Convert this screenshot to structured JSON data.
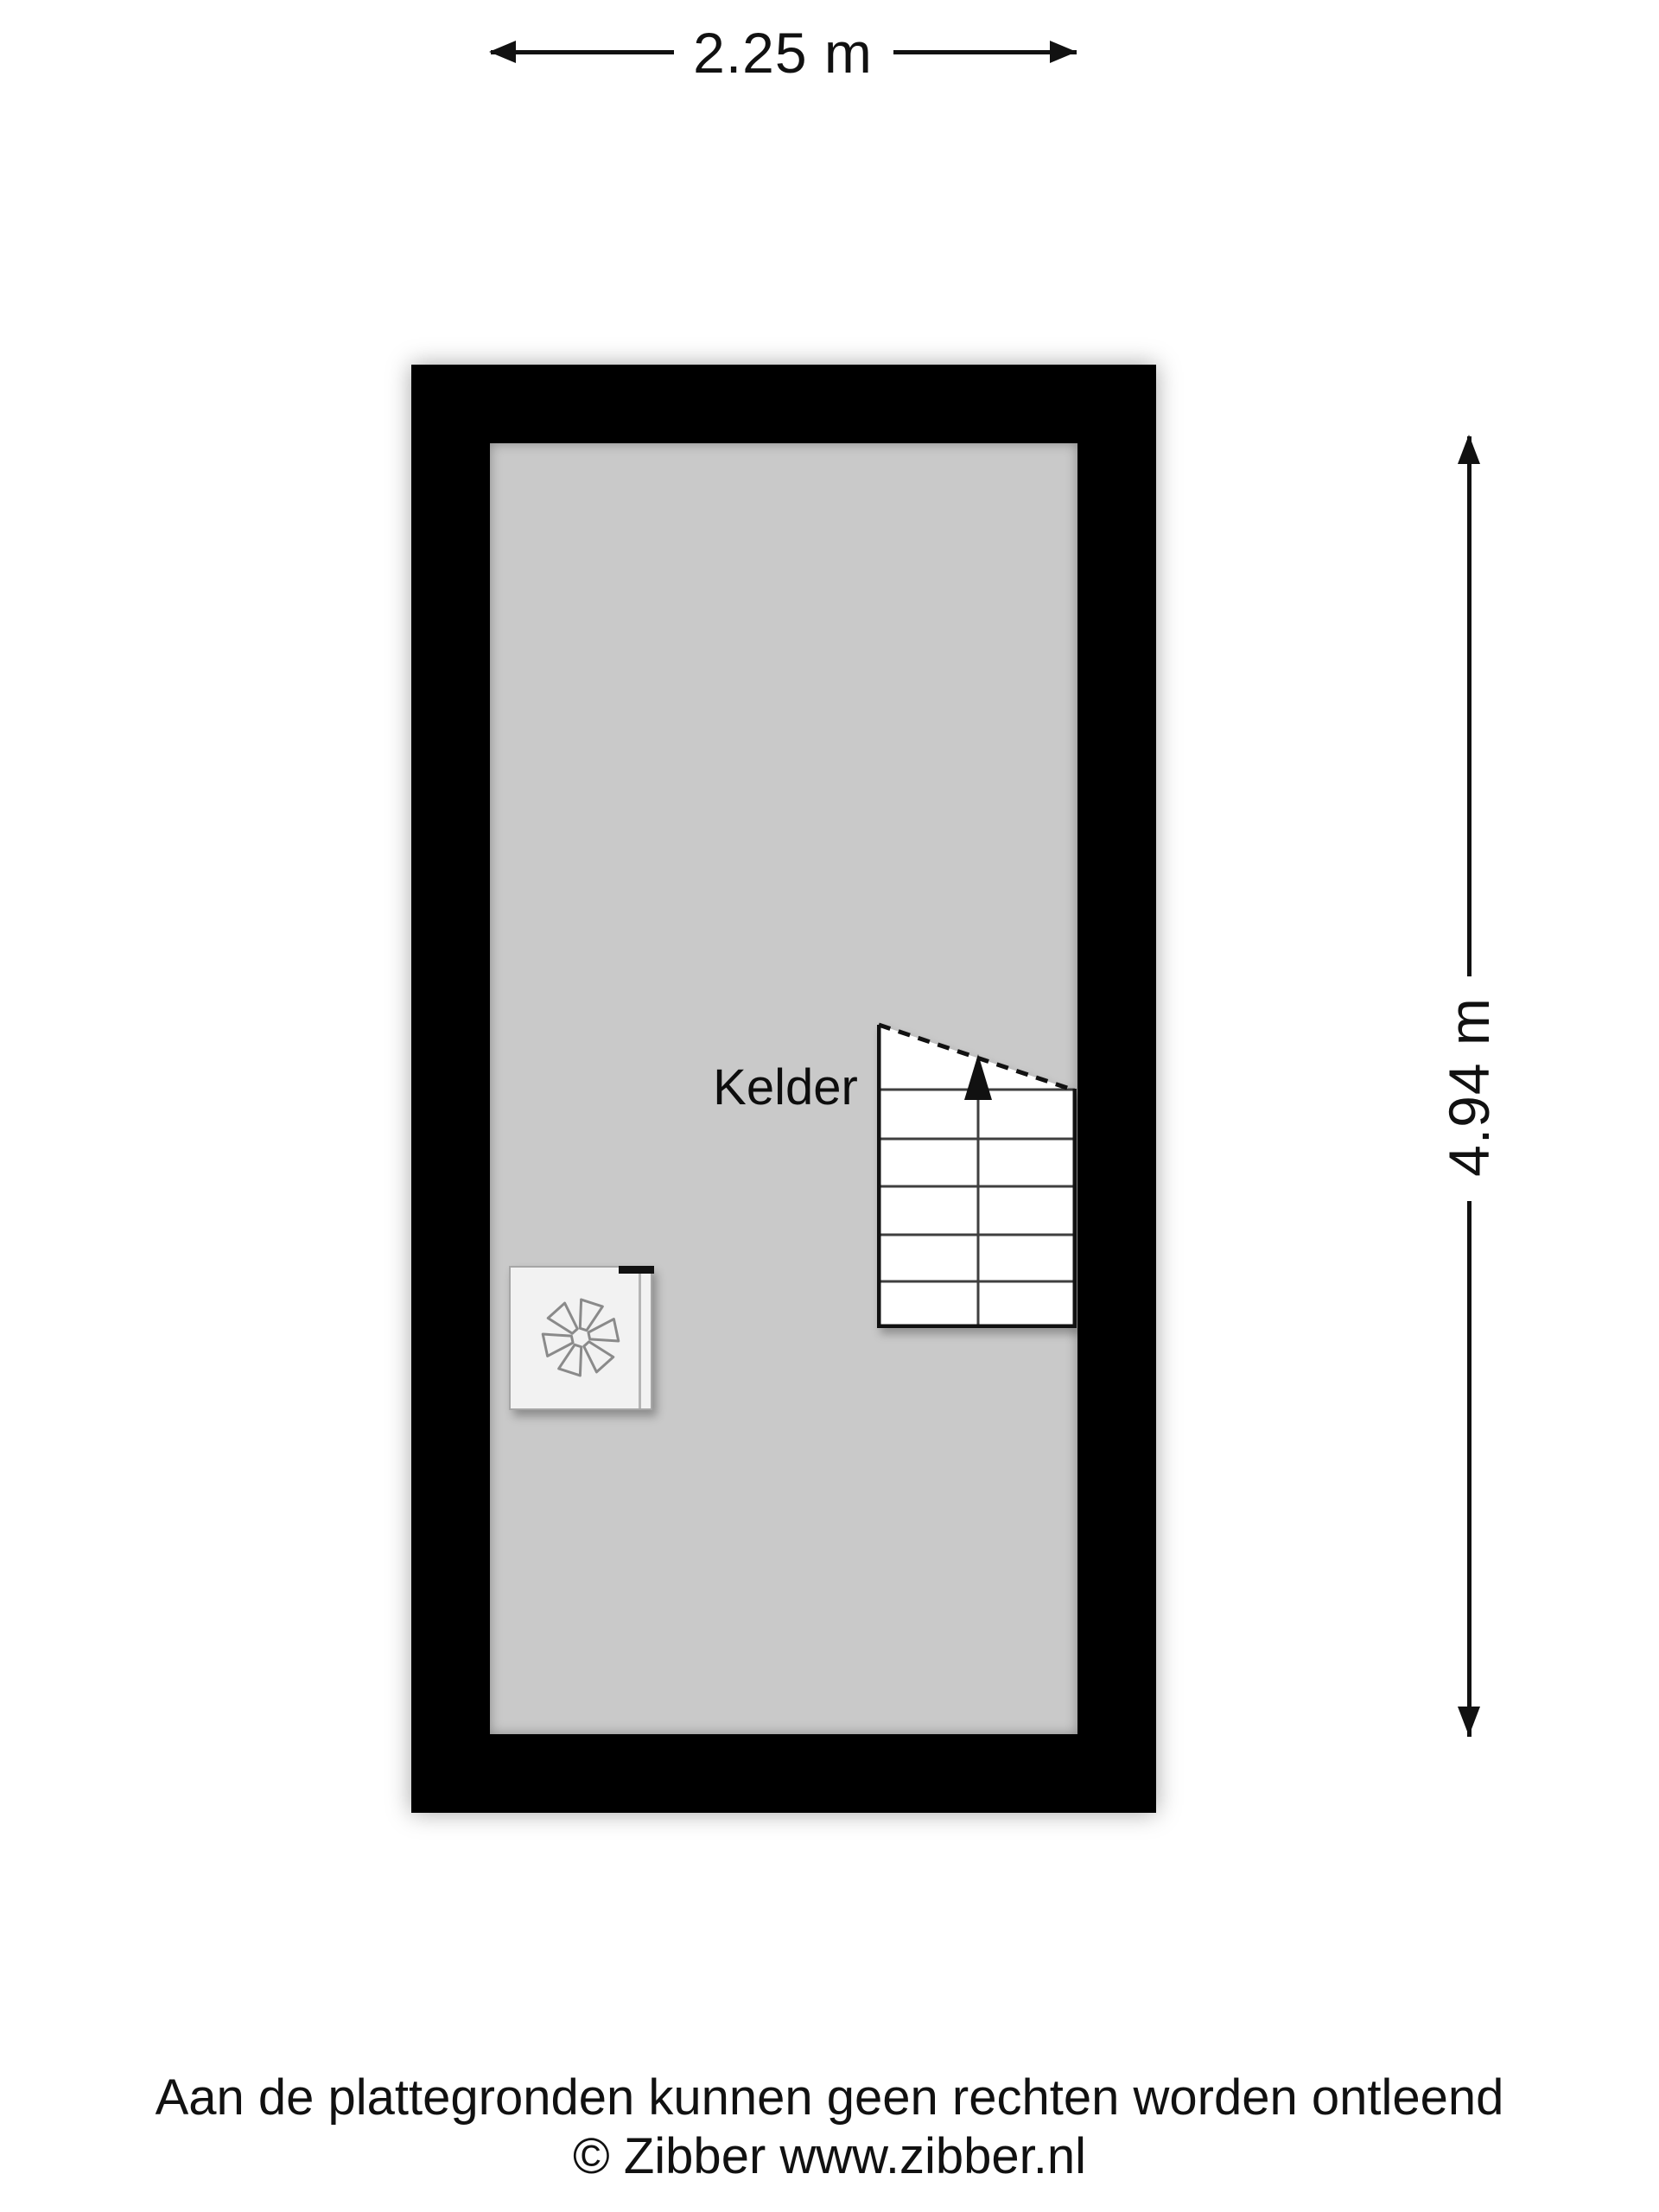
{
  "floorplan": {
    "room_label": "Kelder",
    "width_dimension_label": "2.25 m",
    "height_dimension_label": "4.94 m"
  },
  "stairs": {
    "type": "staircase",
    "direction": "up",
    "tread_rows": 6
  },
  "ventilation_unit": {
    "symbol": "fan-asterisk"
  },
  "footer": {
    "disclaimer": "Aan de plattegronden kunnen geen rechten worden ontleend",
    "copyright": "© Zibber www.zibber.nl"
  },
  "colors": {
    "background": "#ffffff",
    "wall": "#000000",
    "floor_fill": "#c9c9c9",
    "stairs_fill": "#ffffff",
    "vent_fill": "#f2f2f2",
    "text": "#111111"
  }
}
